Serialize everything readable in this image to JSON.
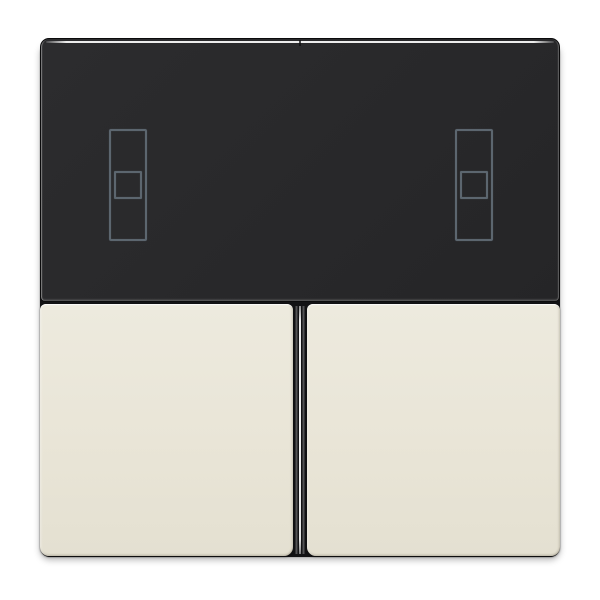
{
  "image_type": "product-photo",
  "colors": {
    "background": "#ffffff",
    "base-dark": "#121214",
    "panel-bg": "#28282a",
    "panel-highlight": "#ededed",
    "icon-stroke": "#5c666f",
    "button-top": "#edeade",
    "button-mid": "#e9e5d7",
    "button-bottom": "#e4e0d1",
    "gap-highlight": "#ececec"
  },
  "device": {
    "display_panel": {
      "icons": [
        {
          "name": "shutter-position-indicator-left"
        },
        {
          "name": "shutter-position-indicator-right"
        }
      ]
    },
    "rockers": [
      {
        "name": "left-rocker"
      },
      {
        "name": "right-rocker"
      }
    ]
  }
}
